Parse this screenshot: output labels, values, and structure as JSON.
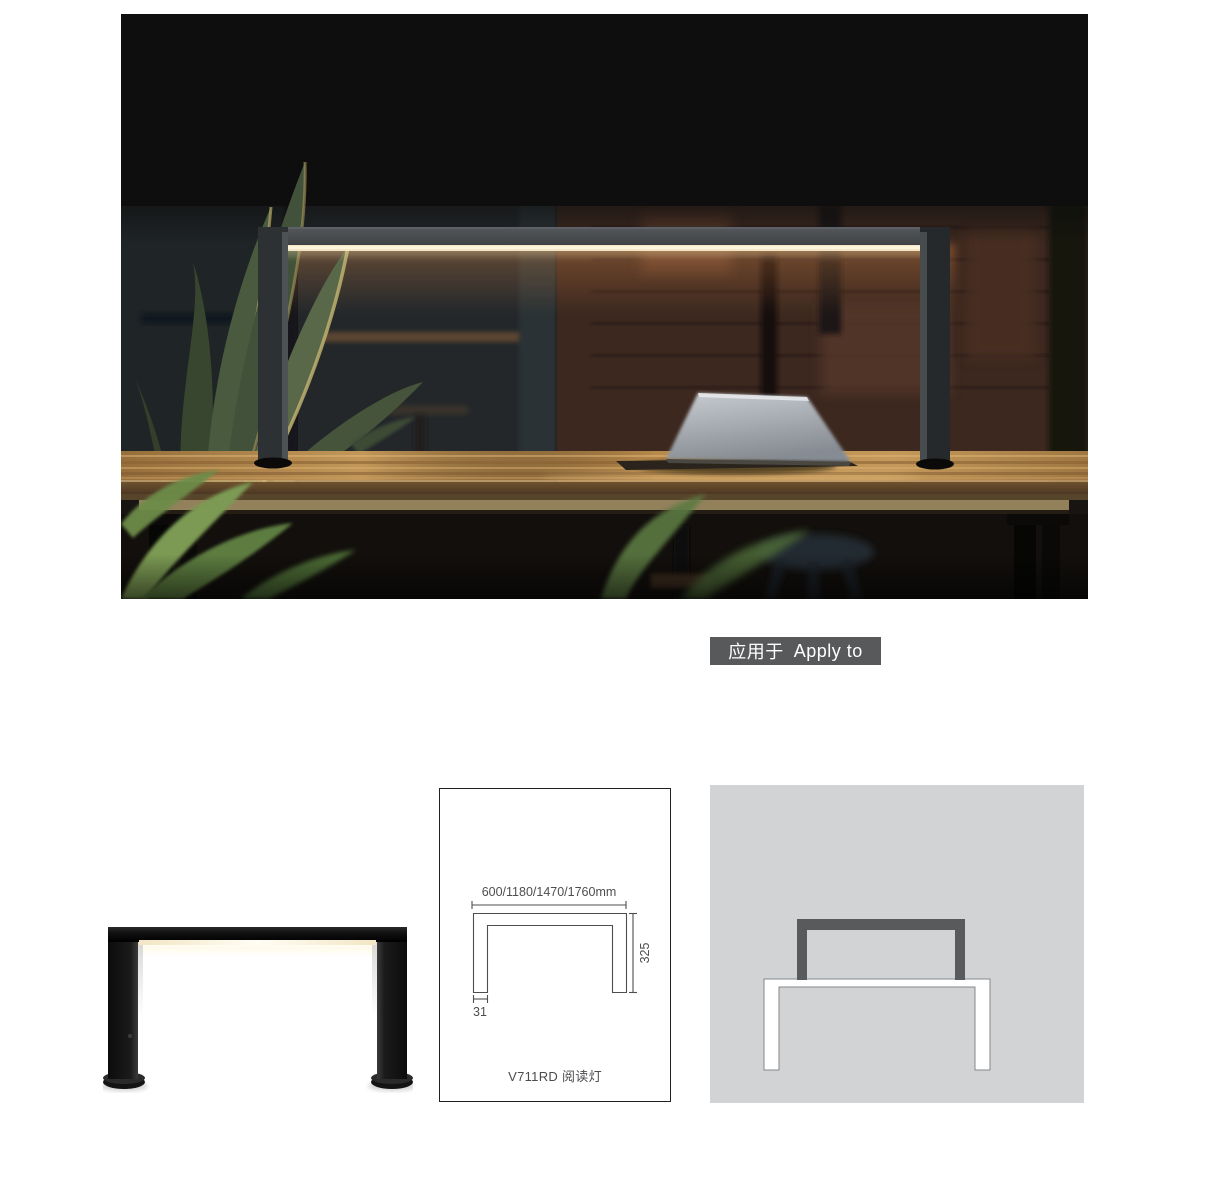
{
  "badge": {
    "zh": "应用于",
    "en": "Apply to"
  },
  "spec": {
    "width_range": "600/1180/1470/1760mm",
    "height": "325",
    "base_width": "31",
    "model": "V711RD 阅读灯"
  },
  "colors": {
    "badge_bg": "#58595b",
    "panel_bg": "#d1d3d4",
    "dimension_line": "#4d4e50",
    "diagram_lamp": "#595a5c",
    "light_strip": "#f4e6c4"
  }
}
